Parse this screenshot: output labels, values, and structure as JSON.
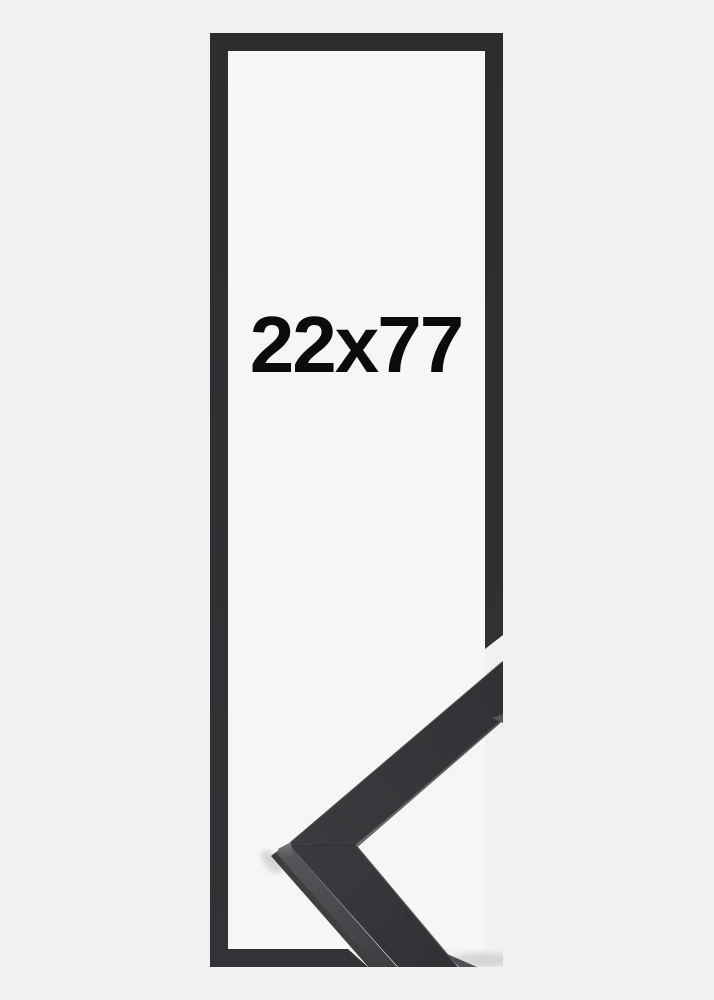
{
  "product": {
    "size_label": "22x77",
    "colors": {
      "page_background": "#f1f1f2",
      "inner_background": "#f6f6f7",
      "frame_outline": "#2f3032",
      "moulding_top_face": "#343539",
      "moulding_top_face_light": "#3b3c3f",
      "moulding_side_face": "#56575a",
      "moulding_shadow_edge": "#1e1f21",
      "text": "#0b0b0c"
    }
  }
}
